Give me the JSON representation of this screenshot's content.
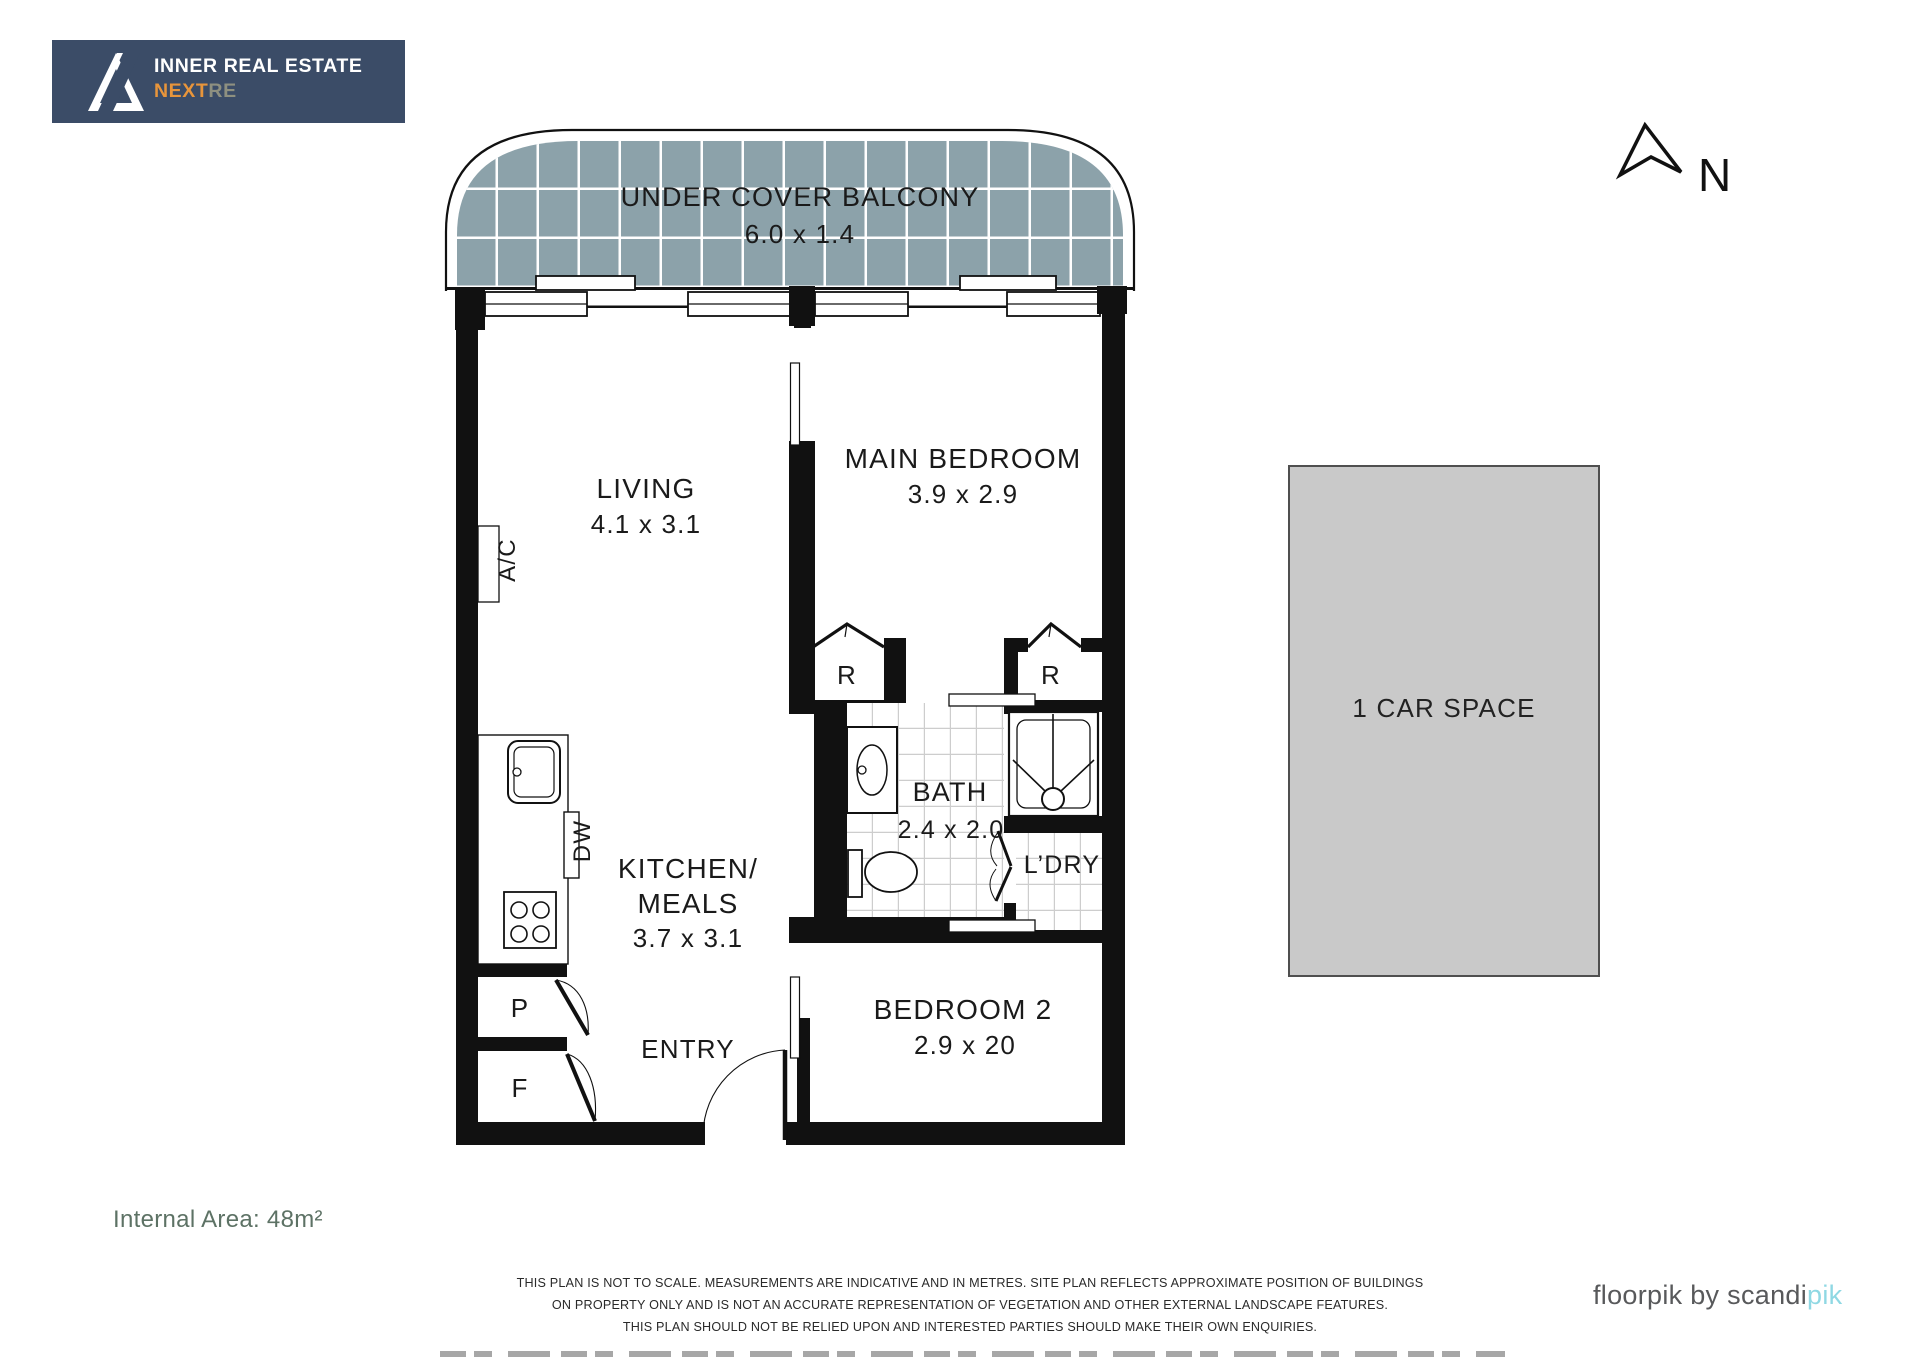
{
  "branding": {
    "agency_line1": "INNER REAL ESTATE",
    "agency_line2_bold": "NEXT",
    "agency_line2_light": "RE"
  },
  "north": {
    "label": "N"
  },
  "plan": {
    "balcony": {
      "name": "UNDER COVER BALCONY",
      "dims": "6.0 x 1.4"
    },
    "living": {
      "name": "LIVING",
      "dims": "4.1 x 3.1"
    },
    "main_bedroom": {
      "name": "MAIN BEDROOM",
      "dims": "3.9 x 2.9"
    },
    "kitchen": {
      "name_line1": "KITCHEN/",
      "name_line2": "MEALS",
      "dims": "3.7 x 3.1"
    },
    "bath": {
      "name": "BATH",
      "dims": "2.4 x 2.0"
    },
    "laundry": {
      "name": "L’DRY"
    },
    "entry": {
      "name": "ENTRY"
    },
    "bedroom2": {
      "name": "BEDROOM 2",
      "dims": "2.9 x 20"
    },
    "robe_left": "R",
    "robe_right": "R",
    "ac_label": "A/C",
    "dw_label": "DW",
    "pantry_label": "P",
    "fridge_label": "F"
  },
  "car_space": {
    "label": "1 CAR SPACE"
  },
  "footer": {
    "internal_area": "Internal Area: 48m²",
    "disclaimer_line1": "THIS PLAN IS NOT TO SCALE. MEASUREMENTS ARE INDICATIVE AND IN METRES. SITE PLAN REFLECTS APPROXIMATE POSITION OF BUILDINGS",
    "disclaimer_line2": "ON PROPERTY ONLY AND IS NOT AN ACCURATE REPRESENTATION OF VEGETATION AND OTHER EXTERNAL LANDSCAPE FEATURES.",
    "disclaimer_line3": "THIS PLAN SHOULD NOT BE RELIED UPON AND INTERESTED PARTIES SHOULD MAKE THEIR OWN ENQUIRIES.",
    "credit_dark": "floorpik by scandi",
    "credit_light": "pik"
  },
  "colors": {
    "brand_navy": "#3b4c67",
    "brand_orange": "#e8953b",
    "balcony_tile": "#8ca2aa",
    "car_space_fill": "#c9c9c9",
    "internal_area_text": "#5d7265",
    "credit_accent": "#8fd8e3"
  }
}
